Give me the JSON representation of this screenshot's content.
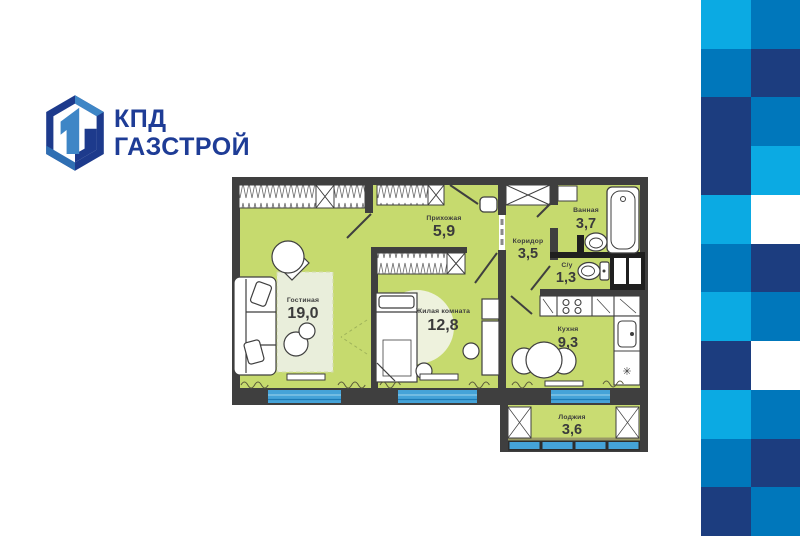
{
  "logo": {
    "line1": "КПД",
    "line2": "ГАЗСТРОЙ"
  },
  "colors": {
    "logo_navy": "#1d3a8c",
    "logo_blue": "#3e86c6",
    "logo_text": "#1e3c96",
    "floor_green": "#c6da6e",
    "wall_dark": "#3f3f3f",
    "window_blue": "#45a3d8",
    "rug_light": "#e9eedb",
    "pattern_light": "#0baae3",
    "pattern_medium": "#0077bb",
    "pattern_navy": "#1c3d7f"
  },
  "plan": {
    "rooms": [
      {
        "id": "living",
        "name": "Гостиная",
        "area": "19,0"
      },
      {
        "id": "hallway",
        "name": "Прихожая",
        "area": "5,9"
      },
      {
        "id": "bedroom",
        "name": "Жилая комната",
        "area": "12,8"
      },
      {
        "id": "corridor",
        "name": "Коридор",
        "area": "3,5"
      },
      {
        "id": "bathroom",
        "name": "Ванная",
        "area": "3,7"
      },
      {
        "id": "wc",
        "name": "С/у",
        "area": "1,3"
      },
      {
        "id": "kitchen",
        "name": "Кухня",
        "area": "9,3"
      },
      {
        "id": "loggia",
        "name": "Лоджия",
        "area": "3,6"
      }
    ],
    "fridge_icon": "✳"
  },
  "pattern": {
    "rows": [
      [
        "light",
        "medium"
      ],
      [
        "medium",
        "navy"
      ],
      [
        "navy",
        "medium"
      ],
      [
        "navy",
        "light"
      ],
      [
        "light",
        "white"
      ],
      [
        "medium",
        "navy"
      ],
      [
        "light",
        "medium"
      ],
      [
        "navy",
        "white"
      ],
      [
        "light",
        "medium"
      ],
      [
        "medium",
        "navy"
      ],
      [
        "navy",
        "medium"
      ]
    ]
  }
}
